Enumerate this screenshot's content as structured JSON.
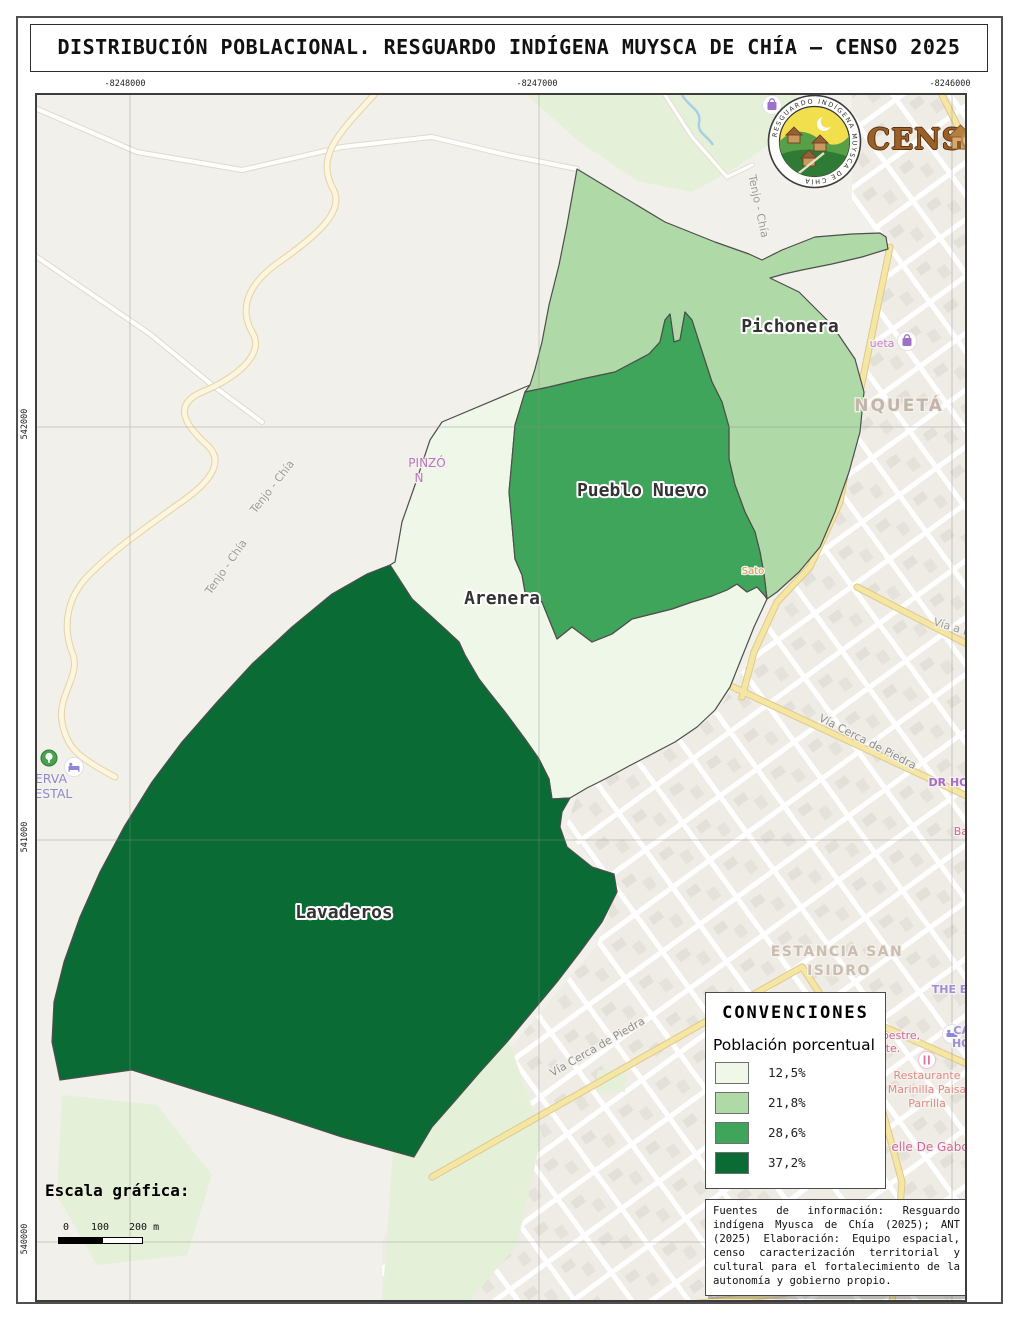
{
  "page": {
    "title": "DISTRIBUCIÓN POBLACIONAL. RESGUARDO INDÍGENA MUYSCA DE CHÍA – CENSO 2025"
  },
  "grid": {
    "top": [
      "-8248000",
      "-8247000",
      "-8246000"
    ],
    "left": [
      "542000",
      "541000",
      "540000"
    ]
  },
  "regions": [
    {
      "id": "arenera",
      "name": "Arenera",
      "pct": "12,5%",
      "color": "#eff7e9",
      "label_x": 465,
      "label_y": 509
    },
    {
      "id": "pichonera",
      "name": "Pichonera",
      "pct": "21,8%",
      "color": "#afd9a6",
      "label_x": 753,
      "label_y": 237
    },
    {
      "id": "pueblo-nuevo",
      "name": "Pueblo Nuevo",
      "pct": "28,6%",
      "color": "#3fa55a",
      "label_x": 605,
      "label_y": 401
    },
    {
      "id": "lavaderos",
      "name": "Lavaderos",
      "pct": "37,2%",
      "color": "#0b6b34",
      "label_x": 307,
      "label_y": 823
    }
  ],
  "legend": {
    "title": "CONVENCIONES",
    "subtitle": "Población porcentual",
    "items": [
      {
        "label": "12,5%",
        "color": "#eff7e9"
      },
      {
        "label": "21,8%",
        "color": "#afd9a6"
      },
      {
        "label": "28,6%",
        "color": "#3fa55a"
      },
      {
        "label": "37,2%",
        "color": "#0b6b34"
      }
    ]
  },
  "scalebar": {
    "title": "Escala gráfica:",
    "tick0": "0",
    "tick1": "100",
    "tick2": "200 m"
  },
  "source_text": "Fuentes de información: Resguardo indígena Myusca de Chía (2025); ANT (2025) Elaboración: Equipo espacial, censo caracterización territorial y cultural para el fortalecimiento de la autonomía y gobierno propio.",
  "logos": {
    "censo": "CENSO",
    "emblem_ring_text": "RESGUARDO INDÍGENA MUYSCA DE CHÍA"
  },
  "map_labels": [
    {
      "t": "Tenjo - Chía",
      "x": 718,
      "y": 112,
      "r": 78,
      "s": 11,
      "c": "#9c9c9c"
    },
    {
      "t": "Tenjo - Chía",
      "x": 238,
      "y": 394,
      "r": -52,
      "s": 11,
      "c": "#9c9c9c"
    },
    {
      "t": "Tenjo - Chía",
      "x": 192,
      "y": 474,
      "r": -55,
      "s": 11,
      "c": "#9c9c9c"
    },
    {
      "t": "Ca",
      "x": 922,
      "y": 48,
      "r": -72,
      "s": 11,
      "c": "#9c9c9c"
    },
    {
      "t": "PINZÓ",
      "x": 390,
      "y": 372,
      "r": 0,
      "s": 12,
      "c": "#bb77bb"
    },
    {
      "t": "N",
      "x": 382,
      "y": 387,
      "r": 0,
      "s": 12,
      "c": "#bb77bb"
    },
    {
      "t": "SERVA",
      "x": 10,
      "y": 688,
      "r": 0,
      "s": 12.5,
      "c": "#8d89cf"
    },
    {
      "t": "RESTAL",
      "x": 12,
      "y": 703,
      "r": 0,
      "s": 12.5,
      "c": "#8d89cf"
    },
    {
      "t": "NQUETÁ",
      "x": 862,
      "y": 316,
      "r": 0,
      "s": 17,
      "c": "#c3b5a9",
      "b": 1,
      "sp": 2
    },
    {
      "t": "ueta",
      "x": 845,
      "y": 252,
      "r": 0,
      "s": 11,
      "c": "#c77fc7"
    },
    {
      "t": "Vía a La V",
      "x": 922,
      "y": 538,
      "r": 17,
      "s": 11,
      "c": "#9c9c9c"
    },
    {
      "t": "Vía Cerca de Piedra",
      "x": 829,
      "y": 650,
      "r": 27,
      "s": 11,
      "c": "#8f8f8f"
    },
    {
      "t": "Vía Cerca de Piedra",
      "x": 562,
      "y": 955,
      "r": -30,
      "s": 11,
      "c": "#8f8f8f"
    },
    {
      "t": "DR HOU",
      "x": 916,
      "y": 691,
      "r": 0,
      "s": 11,
      "c": "#a86bc9",
      "b": 1
    },
    {
      "t": "Barbe",
      "x": 933,
      "y": 740,
      "r": 0,
      "s": 11,
      "c": "#d0679a"
    },
    {
      "t": "ESTANCIA SAN",
      "x": 800,
      "y": 861,
      "r": 0,
      "s": 14,
      "c": "#cbbdb1",
      "b": 1,
      "sp": 1.5
    },
    {
      "t": "ISIDRO",
      "x": 802,
      "y": 880,
      "r": 0,
      "s": 14,
      "c": "#cbbdb1",
      "b": 1,
      "sp": 1.5
    },
    {
      "t": "THE EMER",
      "x": 926,
      "y": 898,
      "r": 0,
      "s": 11,
      "c": "#9e8fd8",
      "b": 1
    },
    {
      "t": "pestre,",
      "x": 864,
      "y": 944,
      "r": 0,
      "s": 11,
      "c": "#d0679a"
    },
    {
      "t": "te.",
      "x": 856,
      "y": 957,
      "r": 0,
      "s": 11,
      "c": "#d0679a"
    },
    {
      "t": "CAT",
      "x": 928,
      "y": 939,
      "r": 0,
      "s": 11,
      "c": "#9e8fd8",
      "b": 1
    },
    {
      "t": "HOT",
      "x": 928,
      "y": 952,
      "r": 0,
      "s": 11,
      "c": "#9e8fd8",
      "b": 1
    },
    {
      "t": "Restaurante",
      "x": 890,
      "y": 984,
      "r": 0,
      "s": 11,
      "c": "#e08a8a"
    },
    {
      "t": "Marinilla Paisa",
      "x": 890,
      "y": 998,
      "r": 0,
      "s": 11,
      "c": "#e08a8a"
    },
    {
      "t": "Parrilla",
      "x": 890,
      "y": 1012,
      "r": 0,
      "s": 11,
      "c": "#e08a8a"
    },
    {
      "t": "elle De Gabo",
      "x": 893,
      "y": 1056,
      "r": 0,
      "s": 12,
      "c": "#d0679a"
    },
    {
      "t": "Carmentea",
      "x": 716,
      "y": 1197,
      "r": 0,
      "s": 12,
      "c": "#e08a8a",
      "b": 1
    },
    {
      "t": "Sato",
      "x": 716,
      "y": 479,
      "r": 0,
      "s": 10,
      "c": "#d69a46"
    }
  ]
}
